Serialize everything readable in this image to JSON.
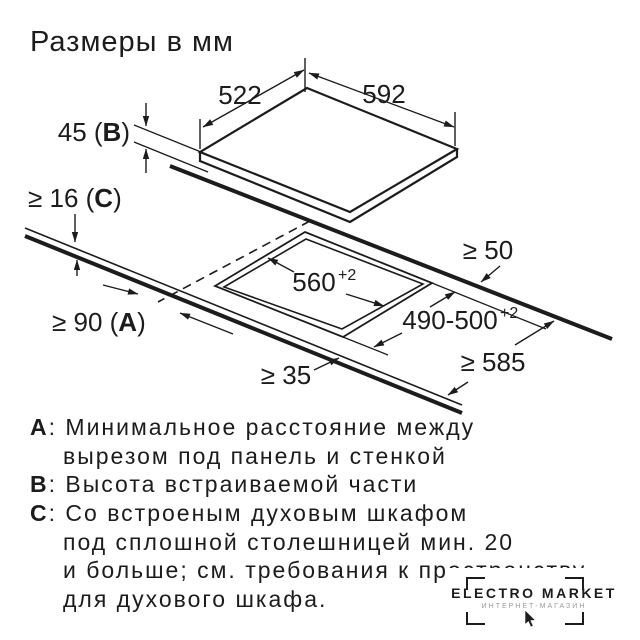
{
  "title": "Размеры в мм",
  "dims": {
    "panel_width_left": "522",
    "panel_width_right": "592",
    "panel_height": {
      "prefix": "45 (",
      "letter": "B",
      "suffix": ")"
    },
    "counter_thickness": {
      "prefix": "≥ 16 (",
      "letter": "C",
      "suffix": ")"
    },
    "wall_clearance": {
      "prefix": "≥ 90 (",
      "letter": "A",
      "suffix": ")"
    },
    "back_clearance": "≥ 50",
    "front_clearance": "≥ 35",
    "counter_depth": "≥ 585",
    "cutout_width": {
      "value": "560",
      "tolerance": "+2"
    },
    "cutout_depth": {
      "value": "490-500",
      "tolerance": "+2"
    }
  },
  "legend": {
    "lines": [
      {
        "letter": "A",
        "sep": ": ",
        "text": "Минимальное расстояние между"
      },
      {
        "letter": "",
        "sep": "",
        "text": "вырезом под панель и стенкой"
      },
      {
        "letter": "B",
        "sep": ": ",
        "text": "Высота встраиваемой части"
      },
      {
        "letter": "C",
        "sep": ": ",
        "text": "Со встроеным духовым шкафом"
      },
      {
        "letter": "",
        "sep": "",
        "text": "под сплошной столешницей мин. 20"
      },
      {
        "letter": "",
        "sep": "",
        "text": "и больше; см. требования к пространству"
      },
      {
        "letter": "",
        "sep": "",
        "text": "для духового шкафа."
      }
    ]
  },
  "watermark": {
    "brand": "ELECTRO MARKET",
    "tagline": "ИНТЕРНЕТ-МАГАЗИН"
  },
  "colors": {
    "ink": "#1c1c1c",
    "paper": "#ffffff",
    "muted": "#9a9a9a"
  }
}
